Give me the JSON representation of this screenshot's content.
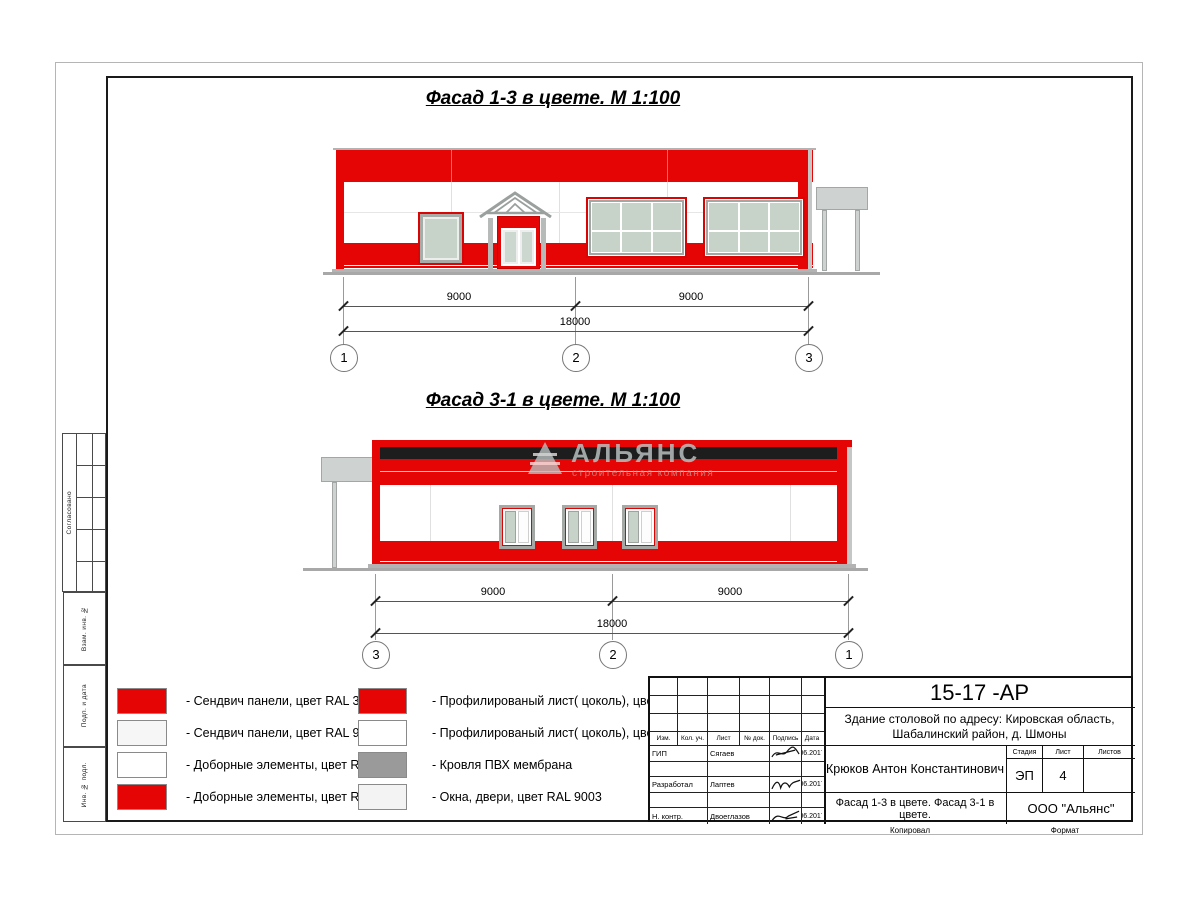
{
  "drawing": {
    "title1": "Фасад 1-3 в цвете.  М 1:100",
    "title2": "Фасад 3-1 в цвете.  М 1:100"
  },
  "watermark": {
    "name": "АЛЬЯНС",
    "tagline": "строительная компания"
  },
  "facade1": {
    "dim_a": "9000",
    "dim_b": "9000",
    "dim_total": "18000",
    "axis_left": "1",
    "axis_mid": "2",
    "axis_right": "3"
  },
  "facade2": {
    "dim_a": "9000",
    "dim_b": "9000",
    "dim_total": "18000",
    "axis_left": "3",
    "axis_mid": "2",
    "axis_right": "1"
  },
  "legend": {
    "col1": [
      {
        "swatch": "#e60505",
        "label": "- Сендвич панели, цвет RAL 3020"
      },
      {
        "swatch": "#f6f6f6",
        "label": "- Сендвич панели, цвет RAL 9003"
      },
      {
        "swatch": "#ffffff",
        "label": "- Доборные элементы, цвет RAL 9003"
      },
      {
        "swatch": "#e60505",
        "label": "- Доборные элементы, цвет RAL 3020"
      }
    ],
    "col2": [
      {
        "swatch": "#e60505",
        "label": "- Профилированый лист( цоколь), цвет RAL 3020"
      },
      {
        "swatch": "#ffffff",
        "label": "- Профилированый лист( цоколь), цвет RAL 9003"
      },
      {
        "swatch": "#9a9a9a",
        "label": "- Кровля ПВХ мембрана"
      },
      {
        "swatch": "#f3f3f3",
        "label": "- Окна, двери, цвет RAL 9003"
      }
    ]
  },
  "sidebar": {
    "approved": "Согласовано",
    "label_vzam": "Взам. инв. №",
    "label_podp": "Подп. и дата",
    "label_inv": "Инв. № подл."
  },
  "titleblock": {
    "doc_code": "15-17 -АР",
    "project_line1": "Здание столовой по адресу: Кировская область,",
    "project_line2": "Шабалинский район, д. Шмоны",
    "cols": {
      "izm": "Изм.",
      "kol": "Кол. уч.",
      "list": "Лист",
      "ndok": "№ док.",
      "podpis": "Подпись",
      "data": "Дата"
    },
    "rows": [
      {
        "role": "ГИП",
        "name": "Сягаев",
        "date": "06.2017"
      },
      {
        "role": "Разработал",
        "name": "Лаптев",
        "date": "06.2017"
      },
      {
        "role": "Н. контр.",
        "name": "Двоеглазов",
        "date": "06.2017"
      }
    ],
    "author": "Крюков Антон Константинович",
    "sheet_name": "Фасад 1-3 в цвете. Фасад 3-1 в цвете.",
    "stage_label": "Стадия",
    "list_label": "Лист",
    "listov_label": "Листов",
    "stage": "ЭП",
    "sheet_no": "4",
    "sheets_total": "",
    "company": "ООО \"Альянс\"",
    "copied": "Копировал",
    "format": "Формат"
  }
}
